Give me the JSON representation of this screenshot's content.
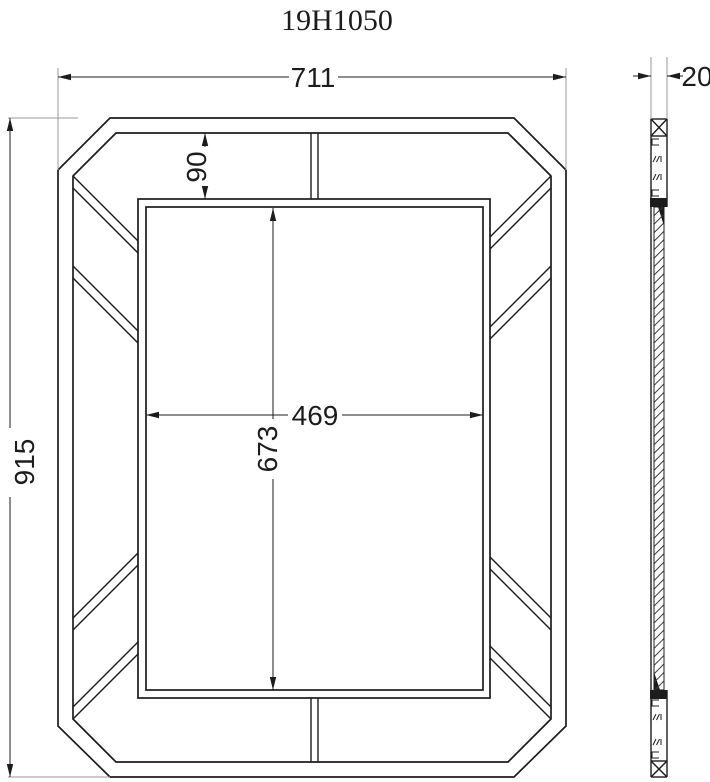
{
  "title": "19H1050",
  "colors": {
    "line": "#1c1c1c",
    "extension_line": "#9a9a9a",
    "hatch": "#3a3a3a",
    "background": "#ffffff"
  },
  "front_view": {
    "name": "mirror-frame-front-view",
    "dimensions": {
      "overall_width": "711",
      "overall_height": "915",
      "band_width": "90",
      "opening_width": "469",
      "opening_height": "673"
    }
  },
  "side_view": {
    "name": "mirror-frame-side-section-view",
    "dimensions": {
      "thickness": "20"
    }
  }
}
